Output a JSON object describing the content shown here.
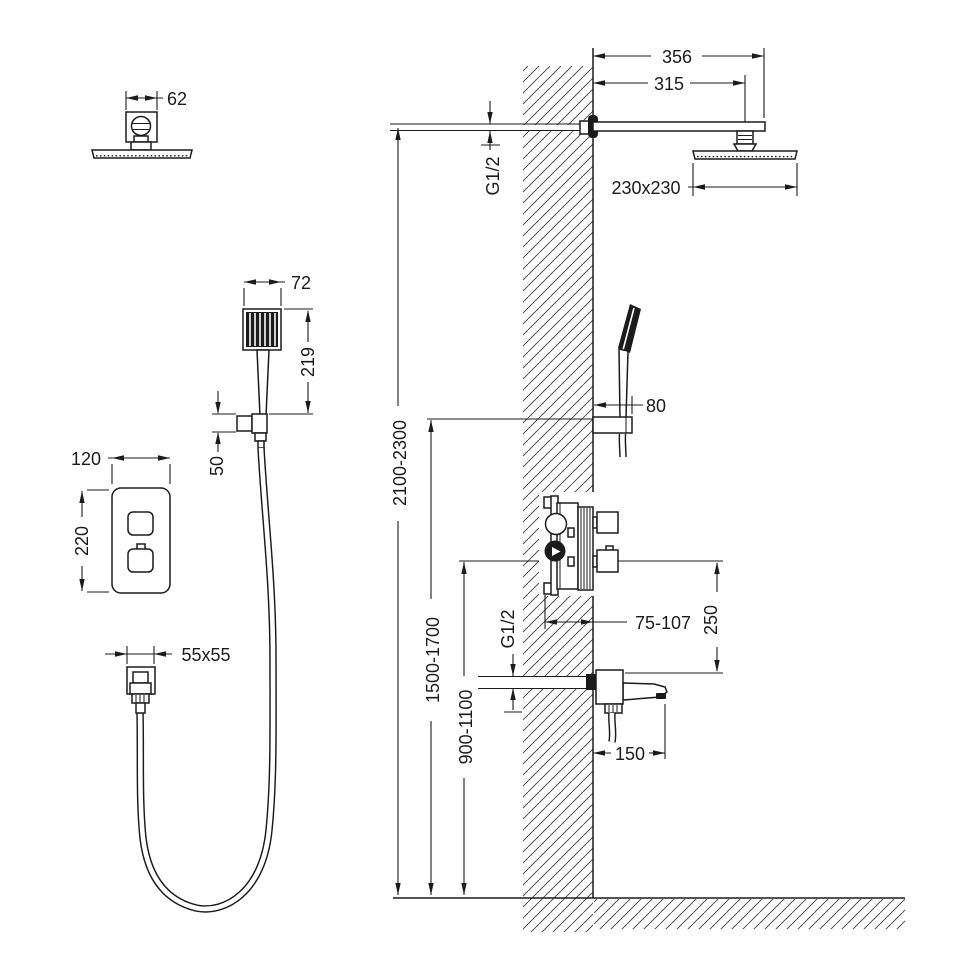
{
  "figure": {
    "left_column": {
      "overhead_top": {
        "width": "62"
      },
      "hand_shower": {
        "width": "72",
        "length": "219",
        "holder": "50"
      },
      "panel": {
        "width": "120",
        "height": "220"
      },
      "outlet": {
        "size": "55x55"
      }
    },
    "wall_view": {
      "arm": {
        "total": "356",
        "center": "315",
        "thread": "G1/2"
      },
      "head": {
        "size": "230x230"
      },
      "holder": {
        "depth": "80"
      },
      "heights": {
        "head": "2100-2300",
        "holder": "1500-1700",
        "mixer": "900-1100"
      },
      "mixer": {
        "depth": "75-107",
        "drop": "250"
      },
      "spout": {
        "thread": "G1/2",
        "reach": "150"
      }
    }
  }
}
